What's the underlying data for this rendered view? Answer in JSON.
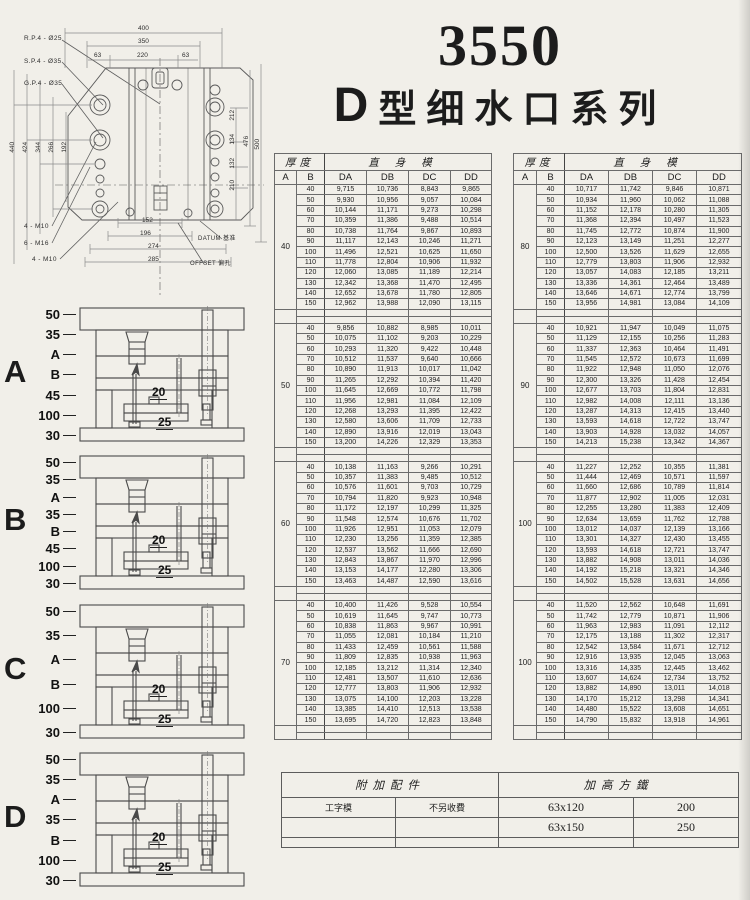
{
  "colors": {
    "paper": "#f1efe9",
    "ink": "#1c1c1c",
    "line": "#555555"
  },
  "header": {
    "model": "3550",
    "series_bold": "D",
    "series_rest": "型细水口系列"
  },
  "drawing": {
    "callout_rp": "R.P.4 - Ø25",
    "callout_sp": "S.P.4 - Ø35",
    "callout_gp": "G.P.4 - Ø35",
    "dim_400": "400",
    "dim_350": "350",
    "dim_63a": "63",
    "dim_220": "220",
    "dim_63b": "63",
    "dim_440": "440",
    "dim_424": "424",
    "dim_344": "344",
    "dim_266": "266",
    "dim_192": "192",
    "dim_212": "212",
    "dim_134": "134",
    "dim_132": "132",
    "dim_210": "210",
    "dim_476": "476",
    "dim_500": "500",
    "dim_152": "152",
    "dim_196": "196",
    "dim_274": "274",
    "dim_285": "285",
    "screws_top": "4 - M10",
    "screws_mid": "6 - M16",
    "screws_bot": "4 - M10",
    "datum": "DATUM  基准",
    "offset": "OFFSET 偏孔"
  },
  "sections": [
    {
      "letter": "A",
      "dims": [
        "50",
        "35",
        "A",
        "B",
        "45",
        "100",
        "30"
      ],
      "inner_top": "20",
      "inner_bottom": "25"
    },
    {
      "letter": "B",
      "dims": [
        "50",
        "35",
        "A",
        "35",
        "B",
        "45",
        "100",
        "30"
      ],
      "inner_top": "20",
      "inner_bottom": "25"
    },
    {
      "letter": "C",
      "dims": [
        "50",
        "35",
        "A",
        "B",
        "100",
        "30"
      ],
      "inner_top": "20",
      "inner_bottom": "25"
    },
    {
      "letter": "D",
      "dims": [
        "50",
        "35",
        "A",
        "35",
        "B",
        "100",
        "30"
      ],
      "inner_top": "20",
      "inner_bottom": "25"
    }
  ],
  "spec": {
    "thickness_header": "厚度",
    "straight_header": "直身模",
    "columns": [
      "A",
      "B",
      "DA",
      "DB",
      "DC",
      "DD"
    ],
    "left_blocks": [
      {
        "A": "40",
        "rows": [
          [
            "40",
            "9,715",
            "10,736",
            "8,843",
            "9,865"
          ],
          [
            "50",
            "9,930",
            "10,956",
            "9,057",
            "10,084"
          ],
          [
            "60",
            "10,144",
            "11,171",
            "9,273",
            "10,298"
          ],
          [
            "70",
            "10,359",
            "11,386",
            "9,488",
            "10,514"
          ],
          [
            "80",
            "10,738",
            "11,764",
            "9,867",
            "10,893"
          ],
          [
            "90",
            "11,117",
            "12,143",
            "10,246",
            "11,271"
          ],
          [
            "100",
            "11,496",
            "12,521",
            "10,625",
            "11,650"
          ],
          [
            "110",
            "11,778",
            "12,804",
            "10,906",
            "11,932"
          ],
          [
            "120",
            "12,060",
            "13,085",
            "11,189",
            "12,214"
          ],
          [
            "130",
            "12,342",
            "13,368",
            "11,470",
            "12,495"
          ],
          [
            "140",
            "12,652",
            "13,678",
            "11,780",
            "12,805"
          ],
          [
            "150",
            "12,962",
            "13,988",
            "12,090",
            "13,115"
          ]
        ]
      },
      {
        "A": "50",
        "rows": [
          [
            "40",
            "9,856",
            "10,882",
            "8,985",
            "10,011"
          ],
          [
            "50",
            "10,075",
            "11,102",
            "9,203",
            "10,229"
          ],
          [
            "60",
            "10,293",
            "11,320",
            "9,422",
            "10,448"
          ],
          [
            "70",
            "10,512",
            "11,537",
            "9,640",
            "10,666"
          ],
          [
            "80",
            "10,890",
            "11,913",
            "10,017",
            "11,042"
          ],
          [
            "90",
            "11,265",
            "12,292",
            "10,394",
            "11,420"
          ],
          [
            "100",
            "11,645",
            "12,669",
            "10,772",
            "11,798"
          ],
          [
            "110",
            "11,956",
            "12,981",
            "11,084",
            "12,109"
          ],
          [
            "120",
            "12,268",
            "13,293",
            "11,395",
            "12,422"
          ],
          [
            "130",
            "12,580",
            "13,606",
            "11,709",
            "12,733"
          ],
          [
            "140",
            "12,890",
            "13,916",
            "12,019",
            "13,043"
          ],
          [
            "150",
            "13,200",
            "14,226",
            "12,329",
            "13,353"
          ]
        ]
      },
      {
        "A": "60",
        "rows": [
          [
            "40",
            "10,138",
            "11,163",
            "9,266",
            "10,291"
          ],
          [
            "50",
            "10,357",
            "11,383",
            "9,485",
            "10,512"
          ],
          [
            "60",
            "10,576",
            "11,601",
            "9,703",
            "10,729"
          ],
          [
            "70",
            "10,794",
            "11,820",
            "9,923",
            "10,948"
          ],
          [
            "80",
            "11,172",
            "12,197",
            "10,299",
            "11,325"
          ],
          [
            "90",
            "11,548",
            "12,574",
            "10,676",
            "11,702"
          ],
          [
            "100",
            "11,926",
            "12,951",
            "11,053",
            "12,079"
          ],
          [
            "110",
            "12,230",
            "13,256",
            "11,359",
            "12,385"
          ],
          [
            "120",
            "12,537",
            "13,562",
            "11,666",
            "12,690"
          ],
          [
            "130",
            "12,843",
            "13,867",
            "11,970",
            "12,996"
          ],
          [
            "140",
            "13,153",
            "14,177",
            "12,280",
            "13,306"
          ],
          [
            "150",
            "13,463",
            "14,487",
            "12,590",
            "13,616"
          ]
        ]
      },
      {
        "A": "70",
        "rows": [
          [
            "40",
            "10,400",
            "11,426",
            "9,528",
            "10,554"
          ],
          [
            "50",
            "10,619",
            "11,645",
            "9,747",
            "10,773"
          ],
          [
            "60",
            "10,838",
            "11,863",
            "9,967",
            "10,991"
          ],
          [
            "70",
            "11,055",
            "12,081",
            "10,184",
            "11,210"
          ],
          [
            "80",
            "11,433",
            "12,459",
            "10,561",
            "11,588"
          ],
          [
            "90",
            "11,809",
            "12,835",
            "10,938",
            "11,963"
          ],
          [
            "100",
            "12,185",
            "13,212",
            "11,314",
            "12,340"
          ],
          [
            "110",
            "12,481",
            "13,507",
            "11,610",
            "12,636"
          ],
          [
            "120",
            "12,777",
            "13,803",
            "11,906",
            "12,932"
          ],
          [
            "130",
            "13,075",
            "14,100",
            "12,203",
            "13,228"
          ],
          [
            "140",
            "13,385",
            "14,410",
            "12,513",
            "13,538"
          ],
          [
            "150",
            "13,695",
            "14,720",
            "12,823",
            "13,848"
          ]
        ]
      }
    ],
    "right_blocks": [
      {
        "A": "80",
        "rows": [
          [
            "40",
            "10,717",
            "11,742",
            "9,846",
            "10,871"
          ],
          [
            "50",
            "10,934",
            "11,960",
            "10,062",
            "11,088"
          ],
          [
            "60",
            "11,152",
            "12,178",
            "10,280",
            "11,305"
          ],
          [
            "70",
            "11,368",
            "12,394",
            "10,497",
            "11,523"
          ],
          [
            "80",
            "11,745",
            "12,772",
            "10,874",
            "11,900"
          ],
          [
            "90",
            "12,123",
            "13,149",
            "11,251",
            "12,277"
          ],
          [
            "100",
            "12,500",
            "13,526",
            "11,629",
            "12,655"
          ],
          [
            "110",
            "12,779",
            "13,803",
            "11,906",
            "12,932"
          ],
          [
            "120",
            "13,057",
            "14,083",
            "12,185",
            "13,211"
          ],
          [
            "130",
            "13,336",
            "14,361",
            "12,464",
            "13,489"
          ],
          [
            "140",
            "13,646",
            "14,671",
            "12,774",
            "13,799"
          ],
          [
            "150",
            "13,956",
            "14,981",
            "13,084",
            "14,109"
          ]
        ]
      },
      {
        "A": "90",
        "rows": [
          [
            "40",
            "10,921",
            "11,947",
            "10,049",
            "11,075"
          ],
          [
            "50",
            "11,129",
            "12,155",
            "10,256",
            "11,283"
          ],
          [
            "60",
            "11,337",
            "12,363",
            "10,464",
            "11,491"
          ],
          [
            "70",
            "11,545",
            "12,572",
            "10,673",
            "11,699"
          ],
          [
            "80",
            "11,922",
            "12,948",
            "11,050",
            "12,076"
          ],
          [
            "90",
            "12,300",
            "13,326",
            "11,428",
            "12,454"
          ],
          [
            "100",
            "12,677",
            "13,703",
            "11,804",
            "12,831"
          ],
          [
            "110",
            "12,982",
            "14,008",
            "12,111",
            "13,136"
          ],
          [
            "120",
            "13,287",
            "14,313",
            "12,415",
            "13,440"
          ],
          [
            "130",
            "13,593",
            "14,618",
            "12,722",
            "13,747"
          ],
          [
            "140",
            "13,903",
            "14,928",
            "13,032",
            "14,057"
          ],
          [
            "150",
            "14,213",
            "15,238",
            "13,342",
            "14,367"
          ]
        ]
      },
      {
        "A": "100",
        "rows": [
          [
            "40",
            "11,227",
            "12,252",
            "10,355",
            "11,381"
          ],
          [
            "50",
            "11,444",
            "12,469",
            "10,571",
            "11,597"
          ],
          [
            "60",
            "11,660",
            "12,686",
            "10,789",
            "11,814"
          ],
          [
            "70",
            "11,877",
            "12,902",
            "11,005",
            "12,031"
          ],
          [
            "80",
            "12,255",
            "13,280",
            "11,383",
            "12,409"
          ],
          [
            "90",
            "12,634",
            "13,659",
            "11,762",
            "12,788"
          ],
          [
            "100",
            "13,012",
            "14,037",
            "12,139",
            "13,166"
          ],
          [
            "110",
            "13,301",
            "14,327",
            "12,430",
            "13,455"
          ],
          [
            "120",
            "13,593",
            "14,618",
            "12,721",
            "13,747"
          ],
          [
            "130",
            "13,882",
            "14,908",
            "13,011",
            "14,036"
          ],
          [
            "140",
            "14,192",
            "15,218",
            "13,321",
            "14,346"
          ],
          [
            "150",
            "14,502",
            "15,528",
            "13,631",
            "14,656"
          ]
        ]
      },
      {
        "A": "100",
        "rows": [
          [
            "40",
            "11,520",
            "12,562",
            "10,648",
            "11,691"
          ],
          [
            "50",
            "11,742",
            "12,779",
            "10,871",
            "11,906"
          ],
          [
            "60",
            "11,963",
            "12,983",
            "11,091",
            "12,112"
          ],
          [
            "70",
            "12,175",
            "13,188",
            "11,302",
            "12,317"
          ],
          [
            "80",
            "12,542",
            "13,584",
            "11,671",
            "12,712"
          ],
          [
            "90",
            "12,916",
            "13,935",
            "12,045",
            "13,063"
          ],
          [
            "100",
            "13,316",
            "14,335",
            "12,445",
            "13,462"
          ],
          [
            "110",
            "13,607",
            "14,624",
            "12,734",
            "13,752"
          ],
          [
            "120",
            "13,882",
            "14,890",
            "13,011",
            "14,018"
          ],
          [
            "130",
            "14,170",
            "15,212",
            "13,298",
            "14,341"
          ],
          [
            "140",
            "14,480",
            "15,522",
            "13,608",
            "14,651"
          ],
          [
            "150",
            "14,790",
            "15,832",
            "13,918",
            "14,961"
          ]
        ]
      }
    ]
  },
  "accessories": {
    "left_header": "附加配件",
    "right_header": "加高方鐵",
    "rows": [
      [
        "工字模",
        "不另收費",
        "63x120",
        "200"
      ],
      [
        "",
        "",
        "63x150",
        "250"
      ]
    ]
  }
}
